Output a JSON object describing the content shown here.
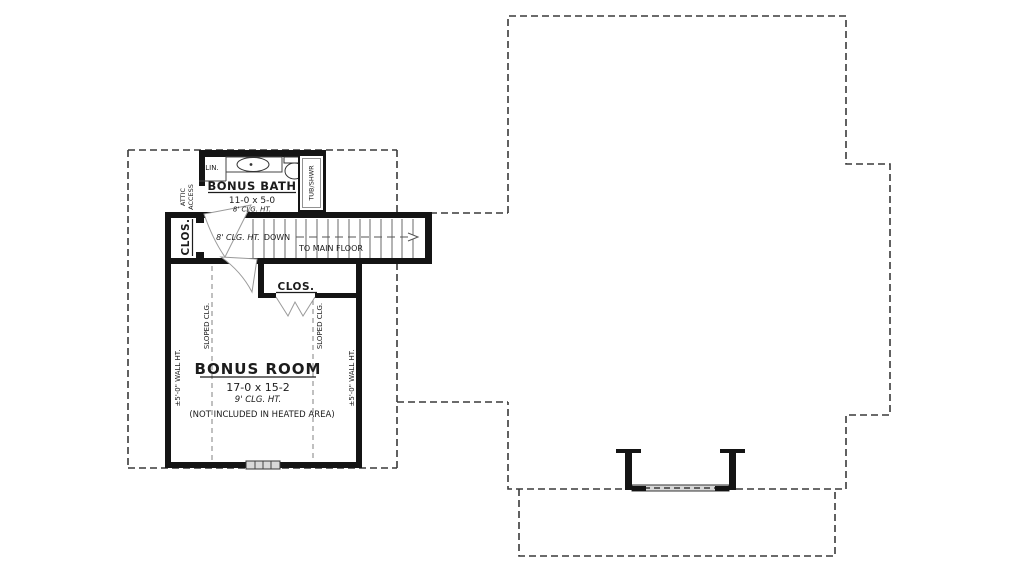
{
  "plan": {
    "colors": {
      "wall": "#141414",
      "dashed_outline": "#3a3a3a",
      "soft_dashed": "#8c8c8c",
      "window_fill": "#d8d8d8"
    },
    "labels": {
      "bath": {
        "title": "BONUS BATH",
        "dims": "11-0 x 5-0",
        "clg": "8' CLG. HT."
      },
      "lin": "LIN.",
      "tub": "TUB/SHWR",
      "attic_line1": "ATTIC",
      "attic_line2": "ACCESS",
      "closet_left": "CLOS.",
      "closet_lower": "CLOS.",
      "hall": {
        "clg": "8' CLG. HT.",
        "down": "DOWN",
        "dest": "TO MAIN FLOOR"
      },
      "room": {
        "title": "BONUS ROOM",
        "dims": "17-0 x 15-2",
        "clg": "9' CLG. HT.",
        "note": "(NOT INCLUDED IN HEATED AREA)"
      },
      "sloped_left": "SLOPED CLG.",
      "sloped_right": "SLOPED CLG.",
      "wall_ht_left": "±5'-0\" WALL HT.",
      "wall_ht_right": "±5'-0\" WALL HT."
    }
  }
}
